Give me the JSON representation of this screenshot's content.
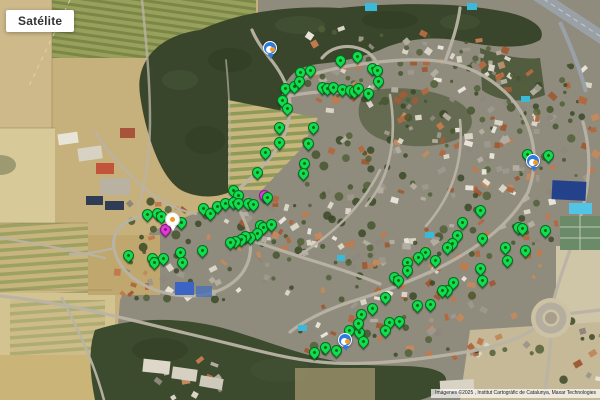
{
  "map": {
    "type_button_label": "Satélite",
    "attribution": "Imágenes ©2025 , Institut Cartogràfic de Catalunya, Maxar Technologies"
  },
  "markers": {
    "green_pins": [
      [
        285,
        88
      ],
      [
        294,
        86
      ],
      [
        282,
        100
      ],
      [
        287,
        108
      ],
      [
        279,
        127
      ],
      [
        279,
        142
      ],
      [
        265,
        152
      ],
      [
        257,
        172
      ],
      [
        233,
        190
      ],
      [
        238,
        195
      ],
      [
        300,
        72
      ],
      [
        299,
        81
      ],
      [
        310,
        70
      ],
      [
        340,
        60
      ],
      [
        357,
        56
      ],
      [
        372,
        68
      ],
      [
        377,
        70
      ],
      [
        378,
        81
      ],
      [
        322,
        87
      ],
      [
        327,
        88
      ],
      [
        333,
        87
      ],
      [
        342,
        89
      ],
      [
        350,
        90
      ],
      [
        354,
        91
      ],
      [
        358,
        88
      ],
      [
        368,
        93
      ],
      [
        313,
        127
      ],
      [
        308,
        143
      ],
      [
        304,
        163
      ],
      [
        303,
        173
      ],
      [
        527,
        154
      ],
      [
        548,
        155
      ],
      [
        147,
        214
      ],
      [
        157,
        213
      ],
      [
        161,
        216
      ],
      [
        181,
        222
      ],
      [
        203,
        208
      ],
      [
        210,
        213
      ],
      [
        217,
        206
      ],
      [
        225,
        203
      ],
      [
        233,
        202
      ],
      [
        238,
        203
      ],
      [
        248,
        203
      ],
      [
        253,
        204
      ],
      [
        267,
        197
      ],
      [
        260,
        225
      ],
      [
        263,
        227
      ],
      [
        271,
        224
      ],
      [
        257,
        233
      ],
      [
        250,
        237
      ],
      [
        245,
        236
      ],
      [
        241,
        239
      ],
      [
        235,
        241
      ],
      [
        230,
        242
      ],
      [
        128,
        255
      ],
      [
        152,
        258
      ],
      [
        154,
        262
      ],
      [
        163,
        258
      ],
      [
        180,
        252
      ],
      [
        182,
        262
      ],
      [
        202,
        250
      ],
      [
        480,
        210
      ],
      [
        462,
        222
      ],
      [
        518,
        227
      ],
      [
        522,
        228
      ],
      [
        545,
        230
      ],
      [
        457,
        235
      ],
      [
        452,
        243
      ],
      [
        482,
        238
      ],
      [
        505,
        247
      ],
      [
        525,
        250
      ],
      [
        507,
        260
      ],
      [
        480,
        268
      ],
      [
        482,
        280
      ],
      [
        447,
        247
      ],
      [
        425,
        252
      ],
      [
        418,
        257
      ],
      [
        435,
        260
      ],
      [
        407,
        262
      ],
      [
        407,
        270
      ],
      [
        394,
        277
      ],
      [
        398,
        280
      ],
      [
        385,
        297
      ],
      [
        453,
        282
      ],
      [
        447,
        290
      ],
      [
        442,
        290
      ],
      [
        417,
        305
      ],
      [
        430,
        304
      ],
      [
        372,
        308
      ],
      [
        361,
        314
      ],
      [
        389,
        322
      ],
      [
        399,
        321
      ],
      [
        349,
        330
      ],
      [
        359,
        332
      ],
      [
        385,
        330
      ],
      [
        363,
        341
      ],
      [
        325,
        347
      ],
      [
        336,
        350
      ],
      [
        314,
        352
      ],
      [
        358,
        323
      ]
    ],
    "magenta_pins": [
      [
        165,
        229
      ],
      [
        264,
        195
      ]
    ],
    "blue_poi_pins": [
      [
        270,
        48
      ],
      [
        533,
        161
      ],
      [
        345,
        340
      ]
    ],
    "white_poi_pins": [
      [
        172,
        219
      ]
    ]
  },
  "colors": {
    "pin_green": "#12dd4c",
    "pin_green_border": "#076b22",
    "pin_magenta": "#e23ad6",
    "pin_magenta_border": "#8c1583",
    "poi_blue": "#2e7ade",
    "poi_orange": "#f59a1e"
  }
}
